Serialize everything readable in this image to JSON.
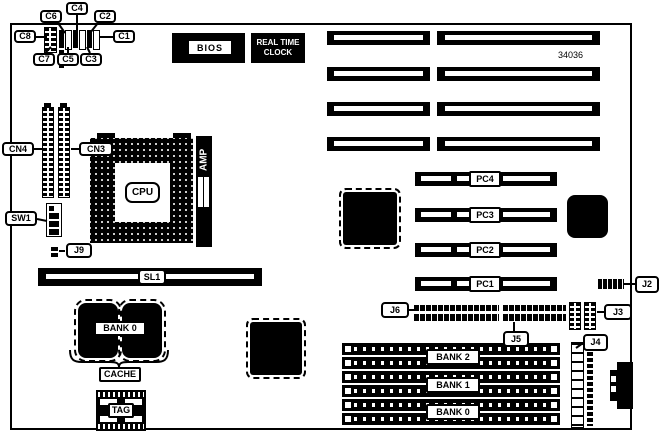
{
  "part_number": "34036",
  "chips": {
    "bios": "BIOS",
    "rtc_line1": "REAL TIME",
    "rtc_line2": "CLOCK",
    "cpu": "CPU",
    "amp": "AMP",
    "tag": "TAG"
  },
  "cache": {
    "bank_label": "BANK 0",
    "label": "CACHE"
  },
  "labels": {
    "c1": "C1",
    "c2": "C2",
    "c3": "C3",
    "c4": "C4",
    "c5": "C5",
    "c6": "C6",
    "c7": "C7",
    "c8": "C8",
    "cn3": "CN3",
    "cn4": "CN4",
    "sw1": "SW1",
    "sl1": "SL1",
    "j2": "J2",
    "j3": "J3",
    "j4": "J4",
    "j5": "J5",
    "j6": "J6",
    "j9": "J9"
  },
  "slots": {
    "pc": [
      "PC4",
      "PC3",
      "PC2",
      "PC1"
    ],
    "simm_banks": [
      "BANK 2",
      "BANK 1",
      "BANK 0"
    ]
  },
  "colors": {
    "ink": "#000000",
    "paper": "#ffffff"
  }
}
